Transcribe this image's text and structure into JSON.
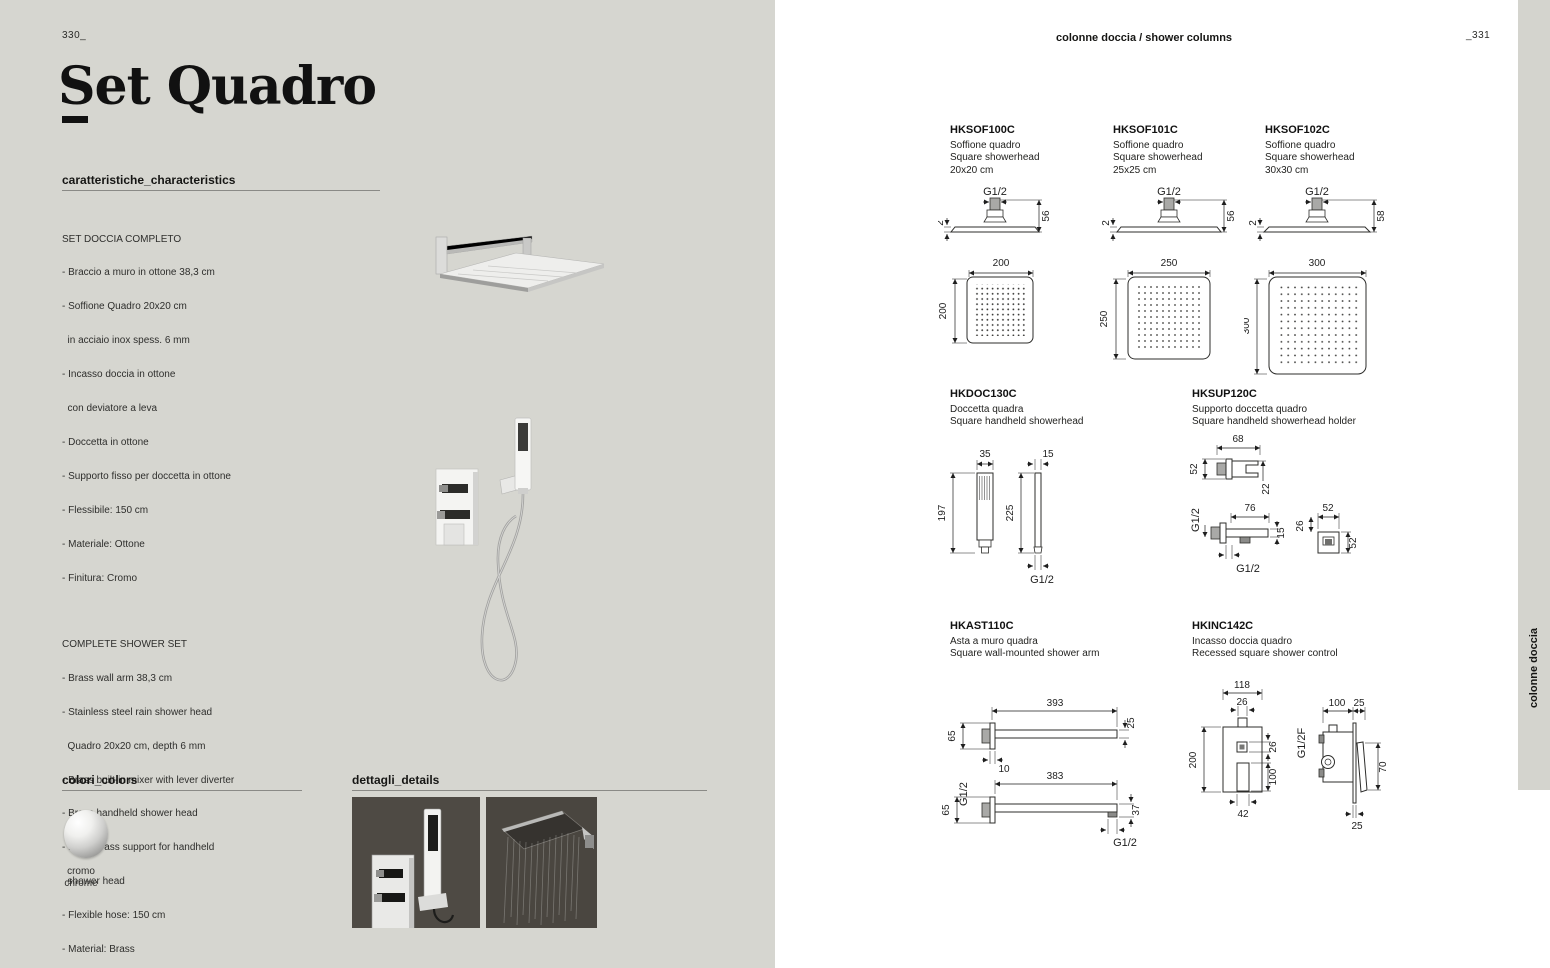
{
  "page": {
    "left_page_number": "330_",
    "right_page_number": "_331",
    "title": "Set Quadro",
    "header_right": "colonne doccia / shower columns",
    "side_tab": "colonne doccia"
  },
  "characteristics": {
    "heading": "caratteristiche_characteristics",
    "italian": {
      "title": "SET DOCCIA COMPLETO",
      "items": [
        "- Braccio a muro in ottone 38,3 cm",
        "- Soffione Quadro 20x20 cm",
        "  in acciaio inox spess. 6 mm",
        "- Incasso doccia in ottone",
        "  con deviatore a leva",
        "- Doccetta in ottone",
        "- Supporto fisso per doccetta in ottone",
        "- Flessibile: 150 cm",
        "- Materiale: Ottone",
        "- Finitura: Cromo"
      ]
    },
    "english": {
      "title": "COMPLETE SHOWER SET",
      "items": [
        "- Brass wall arm 38,3 cm",
        "- Stainless steel rain shower head",
        "  Quadro 20x20 cm, depth 6 mm",
        "- Brass built-in mixer with lever diverter",
        "- Brass handheld shower head",
        "- Fixed brass support for handheld",
        "  shower head",
        "- Flexible hose: 150 cm",
        "- Material: Brass",
        "- Finish: Chrome"
      ]
    }
  },
  "colors_section": {
    "heading": "colori_colors",
    "swatch_label_it": "cromo",
    "swatch_label_en": "chrome"
  },
  "details_section": {
    "heading": "dettagli_details"
  },
  "theme": {
    "page_bg": "#d6d6d0",
    "photo_bg": "#4e4a44",
    "ink": "#1c1c1a"
  },
  "products": [
    {
      "code": "HKSOF100C",
      "name_it": "Soffione quadro",
      "name_en": "Square showerhead",
      "size": "20x20 cm",
      "dims": {
        "thread": "G1/2",
        "thickness": "2",
        "height": "56",
        "face_w": "200",
        "face_h": "200"
      }
    },
    {
      "code": "HKSOF101C",
      "name_it": "Soffione quadro",
      "name_en": "Square showerhead",
      "size": "25x25 cm",
      "dims": {
        "thread": "G1/2",
        "thickness": "2",
        "height": "56",
        "face_w": "250",
        "face_h": "250"
      }
    },
    {
      "code": "HKSOF102C",
      "name_it": "Soffione quadro",
      "name_en": "Square showerhead",
      "size": "30x30 cm",
      "dims": {
        "thread": "G1/2",
        "thickness": "2",
        "height": "58",
        "face_w": "300",
        "face_h": "300"
      }
    },
    {
      "code": "HKDOC130C",
      "name_it": "Doccetta quadra",
      "name_en": "Square handheld showerhead",
      "dims": {
        "front_w": "35",
        "front_h": "197",
        "side_w": "15",
        "side_h": "225",
        "thread": "G1/2"
      }
    },
    {
      "code": "HKSUP120C",
      "name_it": "Supporto doccetta quadro",
      "name_en": "Square handheld showerhead holder",
      "dims": {
        "a_w": "68",
        "a_h": "52",
        "a_d": "22",
        "g_left": "G1/2",
        "b_w": "76",
        "b_lip": "15",
        "g_bottom": "G1/2",
        "c_w": "52",
        "c_off": "26",
        "c_h": "52"
      }
    },
    {
      "code": "HKAST110C",
      "name_it": "Asta a muro quadra",
      "name_en": "Square wall-mounted shower arm",
      "dims": {
        "len_top": "393",
        "end_top": "25",
        "flange_top": "65",
        "depth": "10",
        "len_bot": "383",
        "g_left": "G1/2",
        "flange_bot": "65",
        "end_bot": "37",
        "g_bot": "G1/2"
      }
    },
    {
      "code": "HKINC142C",
      "name_it": "Incasso doccia quadro",
      "name_en": "Recessed square shower control",
      "dims": {
        "w": "118",
        "inlet": "26",
        "h": "200",
        "sq": "26",
        "lever": "100",
        "bottom": "42",
        "d": "100",
        "wall": "25",
        "thread": "G1/2F",
        "handle": "70",
        "d_bottom": "25"
      }
    }
  ]
}
